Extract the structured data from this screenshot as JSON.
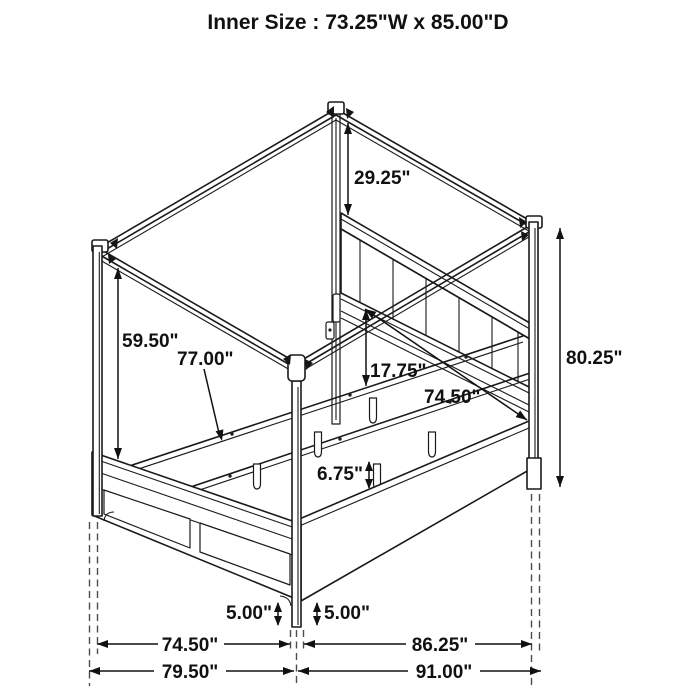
{
  "title": "Inner Size : 73.25\"W x 85.00\"D",
  "dimensions": {
    "canopy_to_headboard": "29.25\"",
    "post_clearance_height": "59.50\"",
    "slat_length": "77.00\"",
    "headboard_to_slat": "17.75\"",
    "slat_area_width": "74.50\"",
    "overall_height": "80.25\"",
    "slat_leg_height": "6.75\"",
    "foot_clearance_left": "5.00\"",
    "foot_clearance_right": "5.00\"",
    "footboard_width": "74.50\"",
    "side_rail_depth": "86.25\"",
    "overall_width": "79.50\"",
    "overall_depth": "91.00\""
  }
}
